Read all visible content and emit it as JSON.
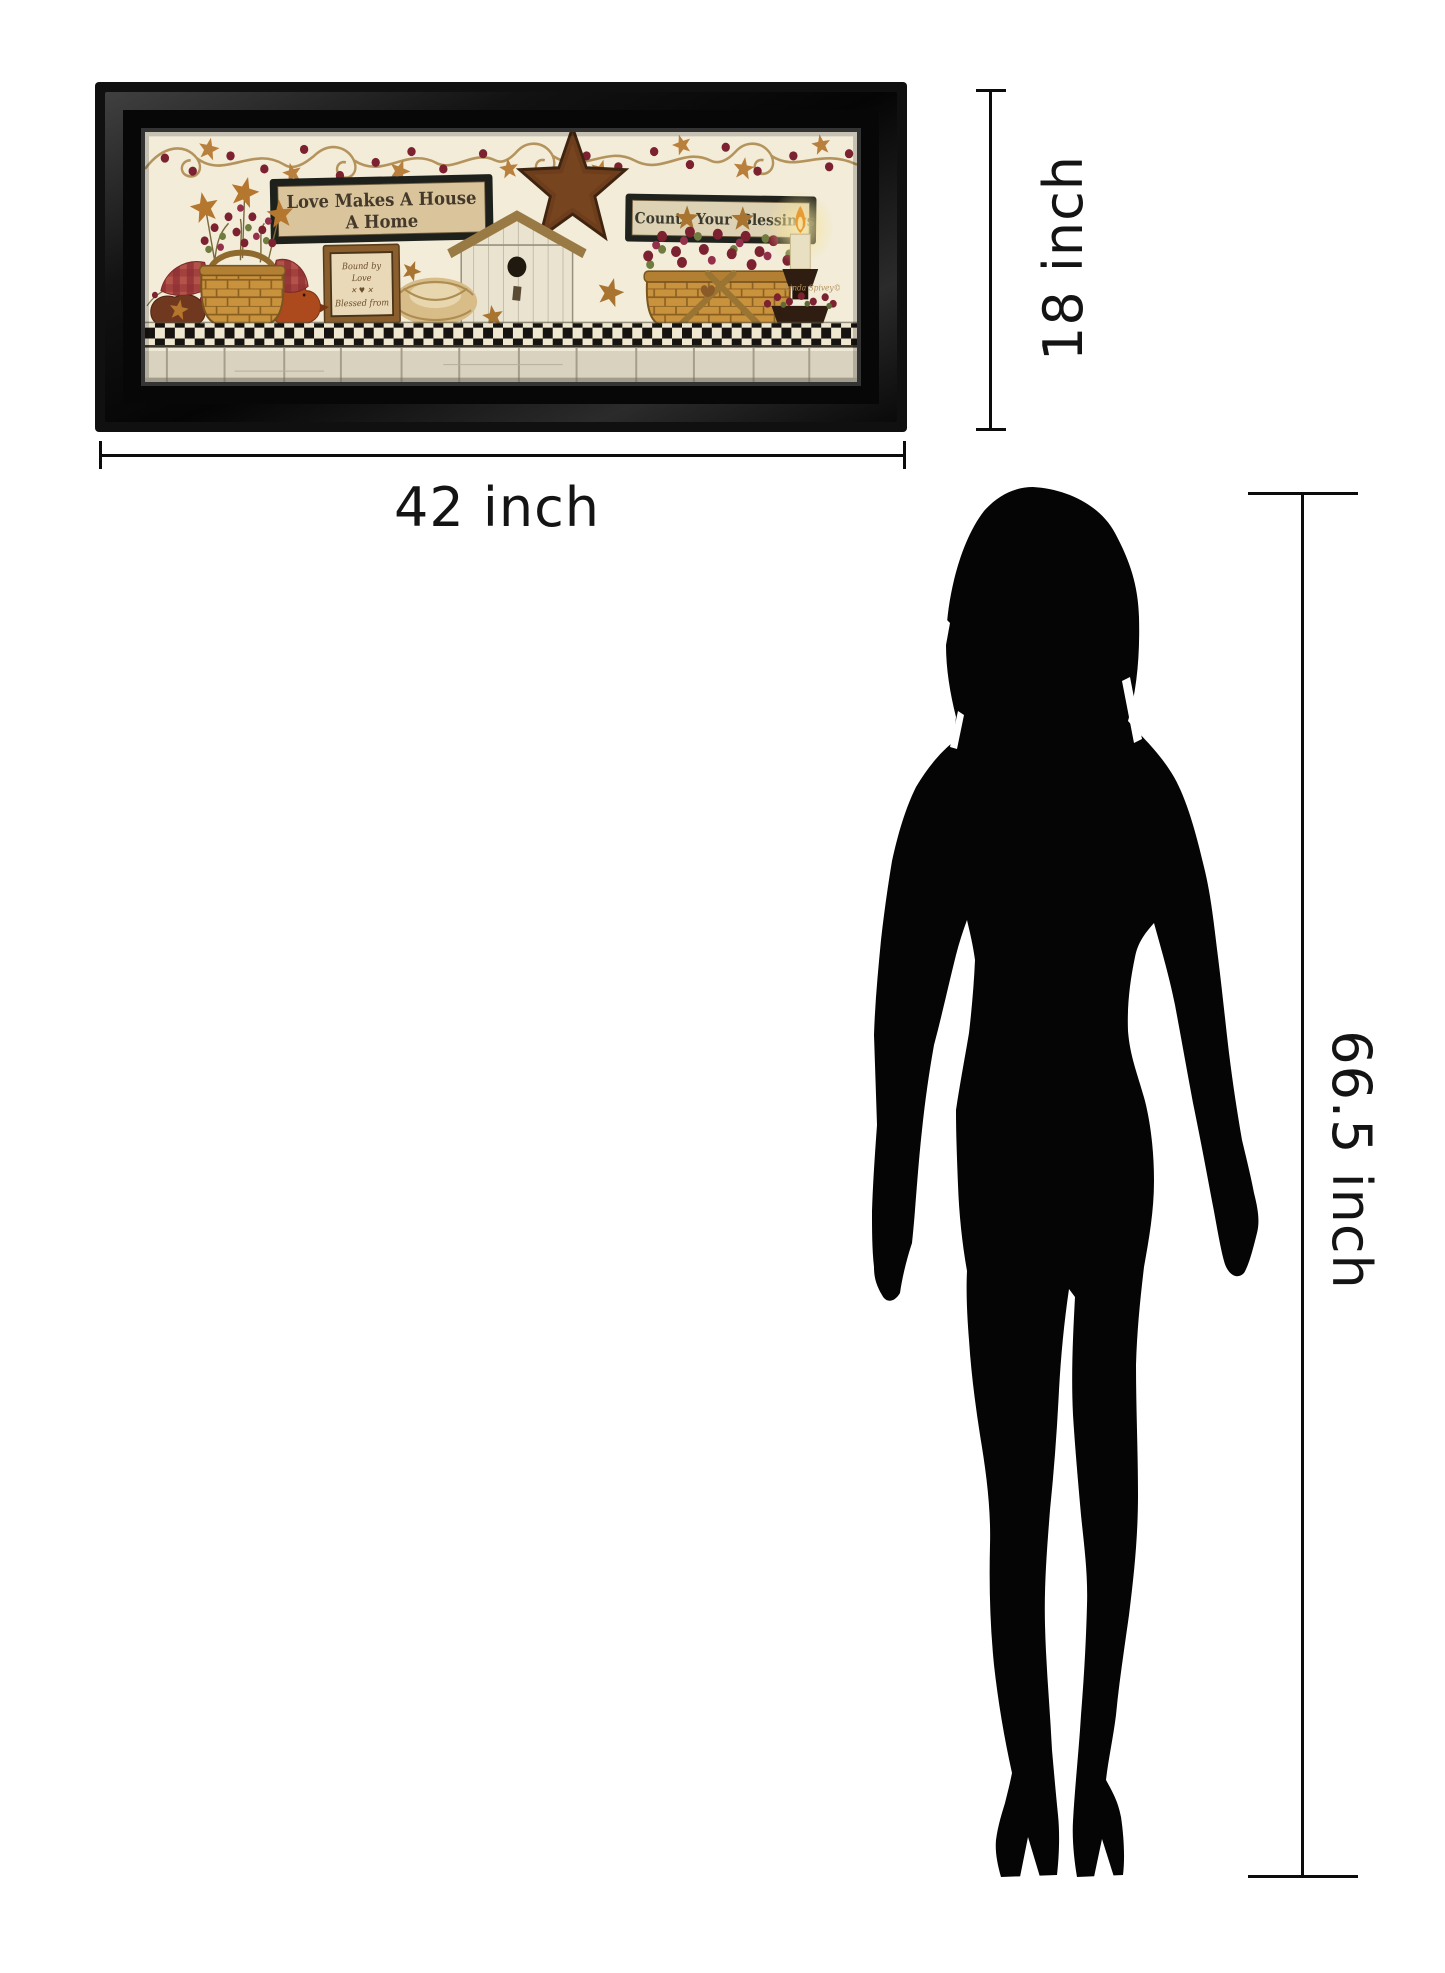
{
  "page": {
    "background": "#ffffff",
    "description": "Framed wall art size diagram with female silhouette for scale"
  },
  "artwork": {
    "frame_color": "#0d0d0d",
    "canvas_color": "#f2ecd9",
    "sign_main": {
      "line1": "Love Makes A House",
      "line2": "A Home"
    },
    "sign_small": {
      "lines": [
        "Bound by",
        "Love",
        "✕ ♥ ✕",
        "Blessed from"
      ]
    },
    "sign_blessings": {
      "word1": "Count",
      "word2": "Your",
      "word3": "Blessings"
    },
    "signature": "Linda Spivey©",
    "palette": {
      "basket": "#c9923d",
      "gingham": "#9c3b38",
      "berry": "#7c2130",
      "barn_star": "#6e3e1c",
      "rust": "#ad4a1d",
      "checker_dark": "#171310",
      "plank": "#d8d2be",
      "candle_glow": "#f6e39a"
    }
  },
  "dimensions": {
    "width_label": "42 inch",
    "height_label": "18 inch",
    "person_height_label": "66.5 inch",
    "line_color": "#0c0c0c"
  },
  "figure": {
    "type": "standing woman silhouette",
    "color": "#050505"
  }
}
